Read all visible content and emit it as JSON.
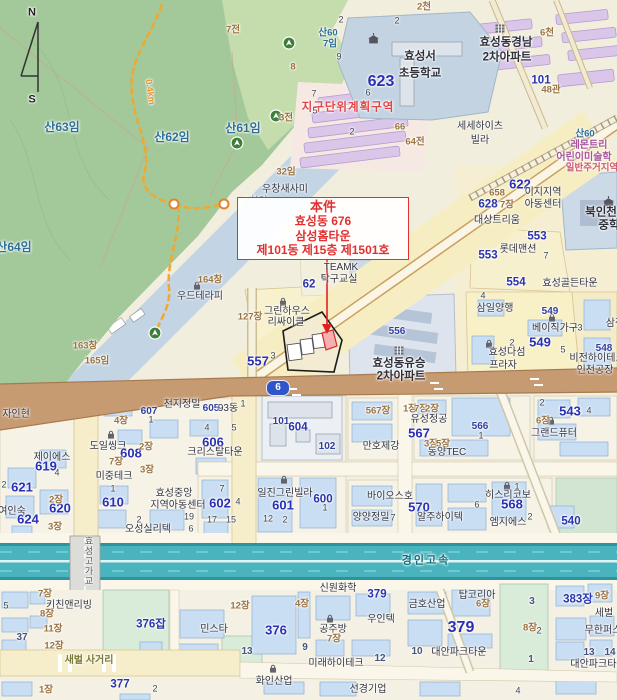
{
  "colors": {
    "mountain": "#a3c89a",
    "major_road": "#c79b72",
    "expressway": "#49b4bd",
    "highlight_red": "#e53030",
    "subject_fill": "#f6b0b0",
    "parcel_blue": "#2a2fb4"
  },
  "compass": {
    "north": "N",
    "south": "S"
  },
  "route_shield": "6",
  "annotation": {
    "tag": "本件",
    "lines": [
      "효성동 676",
      "삼성홈타운",
      "제101동 제15층 제1501호"
    ]
  },
  "labels": [
    {
      "t": "N",
      "x": 32,
      "y": 13,
      "k": "cp"
    },
    {
      "t": "S",
      "x": 32,
      "y": 100,
      "k": "cp"
    },
    {
      "t": "산63임",
      "x": 62,
      "y": 127,
      "k": "mt"
    },
    {
      "t": "산62임",
      "x": 172,
      "y": 137,
      "k": "mt"
    },
    {
      "t": "산61임",
      "x": 243,
      "y": 128,
      "k": "mt"
    },
    {
      "t": "산64임",
      "x": 14,
      "y": 247,
      "k": "mt"
    },
    {
      "t": "산60",
      "x": 328,
      "y": 33,
      "k": "mt2"
    },
    {
      "t": "7임",
      "x": 330,
      "y": 44,
      "k": "mt2"
    },
    {
      "t": "7전",
      "x": 233,
      "y": 30,
      "k": "jb"
    },
    {
      "t": "8",
      "x": 293,
      "y": 67,
      "k": "jb"
    },
    {
      "t": "3전",
      "x": 286,
      "y": 118,
      "k": "jb"
    },
    {
      "t": "32임",
      "x": 286,
      "y": 172,
      "k": "jb"
    },
    {
      "t": "2천",
      "x": 424,
      "y": 7,
      "k": "jb"
    },
    {
      "t": "2",
      "x": 397,
      "y": 21,
      "k": "num"
    },
    {
      "t": "2",
      "x": 341,
      "y": 20,
      "k": "num"
    },
    {
      "t": "효성서",
      "x": 420,
      "y": 57,
      "k": "nm2"
    },
    {
      "t": "초등학교",
      "x": 420,
      "y": 74,
      "k": "nm2"
    },
    {
      "t": "효성동경남",
      "x": 506,
      "y": 43,
      "k": "nm2"
    },
    {
      "t": "2차아파트",
      "x": 507,
      "y": 58,
      "k": "nm2"
    },
    {
      "t": "6천",
      "x": 547,
      "y": 33,
      "k": "jb"
    },
    {
      "t": "623",
      "x": 381,
      "y": 82,
      "k": "b0"
    },
    {
      "t": "지구단위계획구역",
      "x": 348,
      "y": 108,
      "k": "red"
    },
    {
      "t": "9",
      "x": 339,
      "y": 57,
      "k": "num"
    },
    {
      "t": "7",
      "x": 314,
      "y": 94,
      "k": "num"
    },
    {
      "t": "6",
      "x": 368,
      "y": 93,
      "k": "num"
    },
    {
      "t": "5",
      "x": 315,
      "y": 111,
      "k": "num"
    },
    {
      "t": "2",
      "x": 352,
      "y": 132,
      "k": "num"
    },
    {
      "t": "66",
      "x": 400,
      "y": 127,
      "k": "jb"
    },
    {
      "t": "64전",
      "x": 415,
      "y": 142,
      "k": "jb"
    },
    {
      "t": "세세하이츠",
      "x": 480,
      "y": 127,
      "k": "nm"
    },
    {
      "t": "빌라",
      "x": 480,
      "y": 141,
      "k": "nm"
    },
    {
      "t": "101",
      "x": 541,
      "y": 81,
      "k": "b2"
    },
    {
      "t": "48관",
      "x": 551,
      "y": 90,
      "k": "jb"
    },
    {
      "t": "산60",
      "x": 585,
      "y": 134,
      "k": "mt2"
    },
    {
      "t": "레몬트리",
      "x": 589,
      "y": 146,
      "k": "pur"
    },
    {
      "t": "어린이미술학",
      "x": 584,
      "y": 158,
      "k": "pur"
    },
    {
      "t": "일반주거지역",
      "x": 592,
      "y": 168,
      "k": "zon"
    },
    {
      "t": "우창새사미",
      "x": 285,
      "y": 190,
      "k": "nm"
    },
    {
      "t": "2차아",
      "x": 256,
      "y": 202,
      "k": "dim"
    },
    {
      "t": "대상트리움",
      "x": 497,
      "y": 221,
      "k": "nm"
    },
    {
      "t": "622",
      "x": 520,
      "y": 184,
      "k": "b1"
    },
    {
      "t": "658",
      "x": 497,
      "y": 193,
      "k": "jb"
    },
    {
      "t": "628",
      "x": 488,
      "y": 205,
      "k": "b2"
    },
    {
      "t": "7장",
      "x": 507,
      "y": 205,
      "k": "jb"
    },
    {
      "t": "이지지역",
      "x": 543,
      "y": 193,
      "k": "nm"
    },
    {
      "t": "아동센터",
      "x": 543,
      "y": 205,
      "k": "nm"
    },
    {
      "t": "북인천",
      "x": 601,
      "y": 213,
      "k": "nm2"
    },
    {
      "t": "중학",
      "x": 609,
      "y": 226,
      "k": "nm2"
    },
    {
      "t": "553",
      "x": 537,
      "y": 237,
      "k": "b2"
    },
    {
      "t": "롯데맨션",
      "x": 518,
      "y": 250,
      "k": "nm"
    },
    {
      "t": "7",
      "x": 546,
      "y": 256,
      "k": "num"
    },
    {
      "t": "553",
      "x": 488,
      "y": 256,
      "k": "b2"
    },
    {
      "t": "554",
      "x": 516,
      "y": 283,
      "k": "b2"
    },
    {
      "t": "효성골든타운",
      "x": 570,
      "y": 284,
      "k": "nm"
    },
    {
      "t": "삼일양행",
      "x": 495,
      "y": 309,
      "k": "nm"
    },
    {
      "t": "4",
      "x": 483,
      "y": 296,
      "k": "num"
    },
    {
      "t": "549",
      "x": 550,
      "y": 312,
      "k": "b3"
    },
    {
      "t": "베이직가구",
      "x": 555,
      "y": 329,
      "k": "nm"
    },
    {
      "t": "3",
      "x": 580,
      "y": 328,
      "k": "num"
    },
    {
      "t": "549",
      "x": 540,
      "y": 342,
      "k": "b1"
    },
    {
      "t": "2",
      "x": 512,
      "y": 343,
      "k": "num"
    },
    {
      "t": "5",
      "x": 563,
      "y": 350,
      "k": "num"
    },
    {
      "t": "효성다섬",
      "x": 507,
      "y": 353,
      "k": "nm"
    },
    {
      "t": "프라자",
      "x": 503,
      "y": 366,
      "k": "nm"
    },
    {
      "t": "비전하이테크",
      "x": 597,
      "y": 359,
      "k": "nm"
    },
    {
      "t": "인천공장",
      "x": 595,
      "y": 371,
      "k": "nm"
    },
    {
      "t": "548",
      "x": 604,
      "y": 349,
      "k": "b3"
    },
    {
      "t": "삼정",
      "x": 615,
      "y": 324,
      "k": "nm"
    },
    {
      "t": "우드테라피",
      "x": 200,
      "y": 297,
      "k": "nm"
    },
    {
      "t": "164창",
      "x": 210,
      "y": 280,
      "k": "jb"
    },
    {
      "t": "163창",
      "x": 85,
      "y": 346,
      "k": "jb"
    },
    {
      "t": "165임",
      "x": 97,
      "y": 361,
      "k": "jb"
    },
    {
      "t": "127장",
      "x": 250,
      "y": 317,
      "k": "jb"
    },
    {
      "t": "그린하우스",
      "x": 287,
      "y": 312,
      "k": "nm"
    },
    {
      "t": "리싸이클",
      "x": 286,
      "y": 323,
      "k": "nm"
    },
    {
      "t": "557",
      "x": 258,
      "y": 361,
      "k": "b1"
    },
    {
      "t": "3",
      "x": 273,
      "y": 356,
      "k": "num"
    },
    {
      "t": "TEAMK",
      "x": 341,
      "y": 268,
      "k": "nm"
    },
    {
      "t": "탁구교실",
      "x": 339,
      "y": 280,
      "k": "nm"
    },
    {
      "t": "62",
      "x": 309,
      "y": 285,
      "k": "b2"
    },
    {
      "t": "556",
      "x": 397,
      "y": 332,
      "k": "b3"
    },
    {
      "t": "효성동유승",
      "x": 399,
      "y": 364,
      "k": "nm2"
    },
    {
      "t": "2차아파트",
      "x": 401,
      "y": 377,
      "k": "nm2"
    },
    {
      "t": "0.4km",
      "x": 150,
      "y": 92,
      "k": "tr"
    },
    {
      "t": "자인현",
      "x": 16,
      "y": 415,
      "k": "nm"
    },
    {
      "t": "천지정밀",
      "x": 182,
      "y": 405,
      "k": "nm"
    },
    {
      "t": "607",
      "x": 149,
      "y": 412,
      "k": "b3"
    },
    {
      "t": "1",
      "x": 151,
      "y": 420,
      "k": "num"
    },
    {
      "t": "4장",
      "x": 121,
      "y": 421,
      "k": "jb"
    },
    {
      "t": "도일씽크",
      "x": 108,
      "y": 447,
      "k": "nm"
    },
    {
      "t": "608",
      "x": 131,
      "y": 453,
      "k": "b1"
    },
    {
      "t": "2장",
      "x": 146,
      "y": 447,
      "k": "jb"
    },
    {
      "t": "7장",
      "x": 116,
      "y": 462,
      "k": "jb"
    },
    {
      "t": "3장",
      "x": 147,
      "y": 470,
      "k": "jb"
    },
    {
      "t": "미중테크",
      "x": 114,
      "y": 477,
      "k": "nm"
    },
    {
      "t": "1",
      "x": 113,
      "y": 489,
      "k": "num"
    },
    {
      "t": "610",
      "x": 113,
      "y": 502,
      "k": "b1"
    },
    {
      "t": "2",
      "x": 139,
      "y": 520,
      "k": "num"
    },
    {
      "t": "오성실리텍",
      "x": 148,
      "y": 530,
      "k": "nm"
    },
    {
      "t": "효성중앙",
      "x": 174,
      "y": 494,
      "k": "nm"
    },
    {
      "t": "지역아동센터",
      "x": 178,
      "y": 506,
      "k": "nm"
    },
    {
      "t": "19",
      "x": 189,
      "y": 517,
      "k": "num"
    },
    {
      "t": "6",
      "x": 191,
      "y": 529,
      "k": "num"
    },
    {
      "t": "제이에스",
      "x": 52,
      "y": 458,
      "k": "nm"
    },
    {
      "t": "619",
      "x": 46,
      "y": 466,
      "k": "b1"
    },
    {
      "t": "4",
      "x": 57,
      "y": 473,
      "k": "num"
    },
    {
      "t": "621",
      "x": 22,
      "y": 487,
      "k": "b1"
    },
    {
      "t": "2",
      "x": 4,
      "y": 485,
      "k": "num"
    },
    {
      "t": "620",
      "x": 60,
      "y": 508,
      "k": "b1"
    },
    {
      "t": "2장",
      "x": 56,
      "y": 500,
      "k": "jb"
    },
    {
      "t": "624",
      "x": 28,
      "y": 519,
      "k": "b1"
    },
    {
      "t": "3장",
      "x": 55,
      "y": 527,
      "k": "jb"
    },
    {
      "t": "여인숙",
      "x": 12,
      "y": 512,
      "k": "nm"
    },
    {
      "t": "605",
      "x": 211,
      "y": 409,
      "k": "b3"
    },
    {
      "t": "93동",
      "x": 228,
      "y": 409,
      "k": "nm"
    },
    {
      "t": "1",
      "x": 243,
      "y": 404,
      "k": "num"
    },
    {
      "t": "606",
      "x": 213,
      "y": 442,
      "k": "b1"
    },
    {
      "t": "4",
      "x": 207,
      "y": 428,
      "k": "num"
    },
    {
      "t": "5",
      "x": 234,
      "y": 428,
      "k": "num"
    },
    {
      "t": "크리스탈타운",
      "x": 215,
      "y": 453,
      "k": "nm"
    },
    {
      "t": "101",
      "x": 281,
      "y": 422,
      "k": "b3"
    },
    {
      "t": "604",
      "x": 298,
      "y": 428,
      "k": "b2"
    },
    {
      "t": "102",
      "x": 327,
      "y": 447,
      "k": "b3"
    },
    {
      "t": "567장",
      "x": 378,
      "y": 411,
      "k": "jb"
    },
    {
      "t": "만호제강",
      "x": 381,
      "y": 447,
      "k": "nm"
    },
    {
      "t": "567",
      "x": 419,
      "y": 433,
      "k": "b1"
    },
    {
      "t": "유성정공",
      "x": 429,
      "y": 420,
      "k": "nm"
    },
    {
      "t": "1장",
      "x": 410,
      "y": 409,
      "k": "jb"
    },
    {
      "t": "7장",
      "x": 421,
      "y": 409,
      "k": "jb"
    },
    {
      "t": "2장",
      "x": 432,
      "y": 409,
      "k": "jb"
    },
    {
      "t": "3장",
      "x": 431,
      "y": 444,
      "k": "jb"
    },
    {
      "t": "5장",
      "x": 443,
      "y": 444,
      "k": "jb"
    },
    {
      "t": "566",
      "x": 480,
      "y": 427,
      "k": "b3"
    },
    {
      "t": "1",
      "x": 481,
      "y": 436,
      "k": "num"
    },
    {
      "t": "동양TEC",
      "x": 447,
      "y": 453,
      "k": "nm"
    },
    {
      "t": "2",
      "x": 542,
      "y": 403,
      "k": "num"
    },
    {
      "t": "543",
      "x": 570,
      "y": 411,
      "k": "b1"
    },
    {
      "t": "4",
      "x": 589,
      "y": 411,
      "k": "num"
    },
    {
      "t": "6장",
      "x": 543,
      "y": 421,
      "k": "jb"
    },
    {
      "t": "그랜드퓨터",
      "x": 554,
      "y": 434,
      "k": "nm"
    },
    {
      "t": "일진그린빌라",
      "x": 285,
      "y": 494,
      "k": "nm"
    },
    {
      "t": "7",
      "x": 222,
      "y": 489,
      "k": "num"
    },
    {
      "t": "602",
      "x": 220,
      "y": 503,
      "k": "b1"
    },
    {
      "t": "4",
      "x": 238,
      "y": 502,
      "k": "num"
    },
    {
      "t": "601",
      "x": 283,
      "y": 505,
      "k": "b1"
    },
    {
      "t": "600",
      "x": 323,
      "y": 500,
      "k": "b2"
    },
    {
      "t": "1",
      "x": 325,
      "y": 508,
      "k": "num"
    },
    {
      "t": "17",
      "x": 212,
      "y": 520,
      "k": "num"
    },
    {
      "t": "15",
      "x": 231,
      "y": 520,
      "k": "num"
    },
    {
      "t": "12",
      "x": 268,
      "y": 519,
      "k": "num"
    },
    {
      "t": "2",
      "x": 285,
      "y": 520,
      "k": "num"
    },
    {
      "t": "양양정밀",
      "x": 371,
      "y": 518,
      "k": "nm"
    },
    {
      "t": "7",
      "x": 393,
      "y": 518,
      "k": "num"
    },
    {
      "t": "바이오스호",
      "x": 390,
      "y": 497,
      "k": "nm"
    },
    {
      "t": "570",
      "x": 419,
      "y": 507,
      "k": "b1"
    },
    {
      "t": "알주하이텍",
      "x": 440,
      "y": 518,
      "k": "nm"
    },
    {
      "t": "568",
      "x": 512,
      "y": 504,
      "k": "b1"
    },
    {
      "t": "히스리코보",
      "x": 508,
      "y": 496,
      "k": "nm"
    },
    {
      "t": "1",
      "x": 517,
      "y": 487,
      "k": "num"
    },
    {
      "t": "6",
      "x": 477,
      "y": 505,
      "k": "num"
    },
    {
      "t": "2",
      "x": 530,
      "y": 517,
      "k": "num"
    },
    {
      "t": "엠지에스",
      "x": 508,
      "y": 523,
      "k": "nm"
    },
    {
      "t": "540",
      "x": 571,
      "y": 522,
      "k": "b2"
    },
    {
      "t": "경인고속",
      "x": 426,
      "y": 561,
      "k": "hw"
    },
    {
      "t": "효성고가교",
      "x": 88,
      "y": 561,
      "k": "vt"
    },
    {
      "t": "키친앤리빙",
      "x": 69,
      "y": 606,
      "k": "nm"
    },
    {
      "t": "7장",
      "x": 45,
      "y": 594,
      "k": "jb"
    },
    {
      "t": "8장",
      "x": 47,
      "y": 614,
      "k": "jb"
    },
    {
      "t": "11장",
      "x": 53,
      "y": 629,
      "k": "jb"
    },
    {
      "t": "12장",
      "x": 54,
      "y": 646,
      "k": "jb"
    },
    {
      "t": "37",
      "x": 22,
      "y": 638,
      "k": "num2"
    },
    {
      "t": "5",
      "x": 6,
      "y": 606,
      "k": "num"
    },
    {
      "t": "새벌 사거리",
      "x": 89,
      "y": 661,
      "k": "rd"
    },
    {
      "t": "376잡",
      "x": 151,
      "y": 625,
      "k": "b2"
    },
    {
      "t": "민스타",
      "x": 214,
      "y": 630,
      "k": "nm"
    },
    {
      "t": "12장",
      "x": 240,
      "y": 606,
      "k": "jb"
    },
    {
      "t": "13",
      "x": 247,
      "y": 652,
      "k": "num2"
    },
    {
      "t": "376",
      "x": 276,
      "y": 630,
      "k": "b1"
    },
    {
      "t": "4장",
      "x": 302,
      "y": 604,
      "k": "jb"
    },
    {
      "t": "9",
      "x": 305,
      "y": 648,
      "k": "num2"
    },
    {
      "t": "377",
      "x": 120,
      "y": 685,
      "k": "b2"
    },
    {
      "t": "2",
      "x": 155,
      "y": 689,
      "k": "num"
    },
    {
      "t": "1장",
      "x": 46,
      "y": 690,
      "k": "jb"
    },
    {
      "t": "화인산업",
      "x": 274,
      "y": 682,
      "k": "nm"
    },
    {
      "t": "신원화학",
      "x": 338,
      "y": 589,
      "k": "nm"
    },
    {
      "t": "379",
      "x": 377,
      "y": 595,
      "k": "b2"
    },
    {
      "t": "우인텍",
      "x": 381,
      "y": 620,
      "k": "nm"
    },
    {
      "t": "공주방",
      "x": 333,
      "y": 630,
      "k": "nm"
    },
    {
      "t": "7장",
      "x": 334,
      "y": 639,
      "k": "jb"
    },
    {
      "t": "금호산업",
      "x": 427,
      "y": 605,
      "k": "nm"
    },
    {
      "t": "탑코리아",
      "x": 477,
      "y": 596,
      "k": "nm"
    },
    {
      "t": "6장",
      "x": 483,
      "y": 604,
      "k": "jb"
    },
    {
      "t": "3",
      "x": 532,
      "y": 602,
      "k": "num2"
    },
    {
      "t": "379",
      "x": 461,
      "y": 628,
      "k": "b0"
    },
    {
      "t": "8장",
      "x": 530,
      "y": 628,
      "k": "jb"
    },
    {
      "t": "2",
      "x": 539,
      "y": 631,
      "k": "num"
    },
    {
      "t": "10",
      "x": 417,
      "y": 652,
      "k": "num2"
    },
    {
      "t": "대안파크타운",
      "x": 459,
      "y": 653,
      "k": "nm"
    },
    {
      "t": "12",
      "x": 380,
      "y": 659,
      "k": "num2"
    },
    {
      "t": "1",
      "x": 531,
      "y": 660,
      "k": "num2"
    },
    {
      "t": "미래하이테크",
      "x": 336,
      "y": 664,
      "k": "nm"
    },
    {
      "t": "선경기업",
      "x": 368,
      "y": 690,
      "k": "nm"
    },
    {
      "t": "4",
      "x": 518,
      "y": 691,
      "k": "num"
    },
    {
      "t": "383장",
      "x": 578,
      "y": 600,
      "k": "b2"
    },
    {
      "t": "9장",
      "x": 602,
      "y": 596,
      "k": "jb"
    },
    {
      "t": "세벌",
      "x": 604,
      "y": 614,
      "k": "nm"
    },
    {
      "t": "무한퍼스",
      "x": 603,
      "y": 631,
      "k": "nm"
    },
    {
      "t": "13",
      "x": 589,
      "y": 653,
      "k": "num2"
    },
    {
      "t": "14",
      "x": 610,
      "y": 653,
      "k": "num2"
    },
    {
      "t": "대안파크타운",
      "x": 598,
      "y": 665,
      "k": "nm"
    }
  ]
}
